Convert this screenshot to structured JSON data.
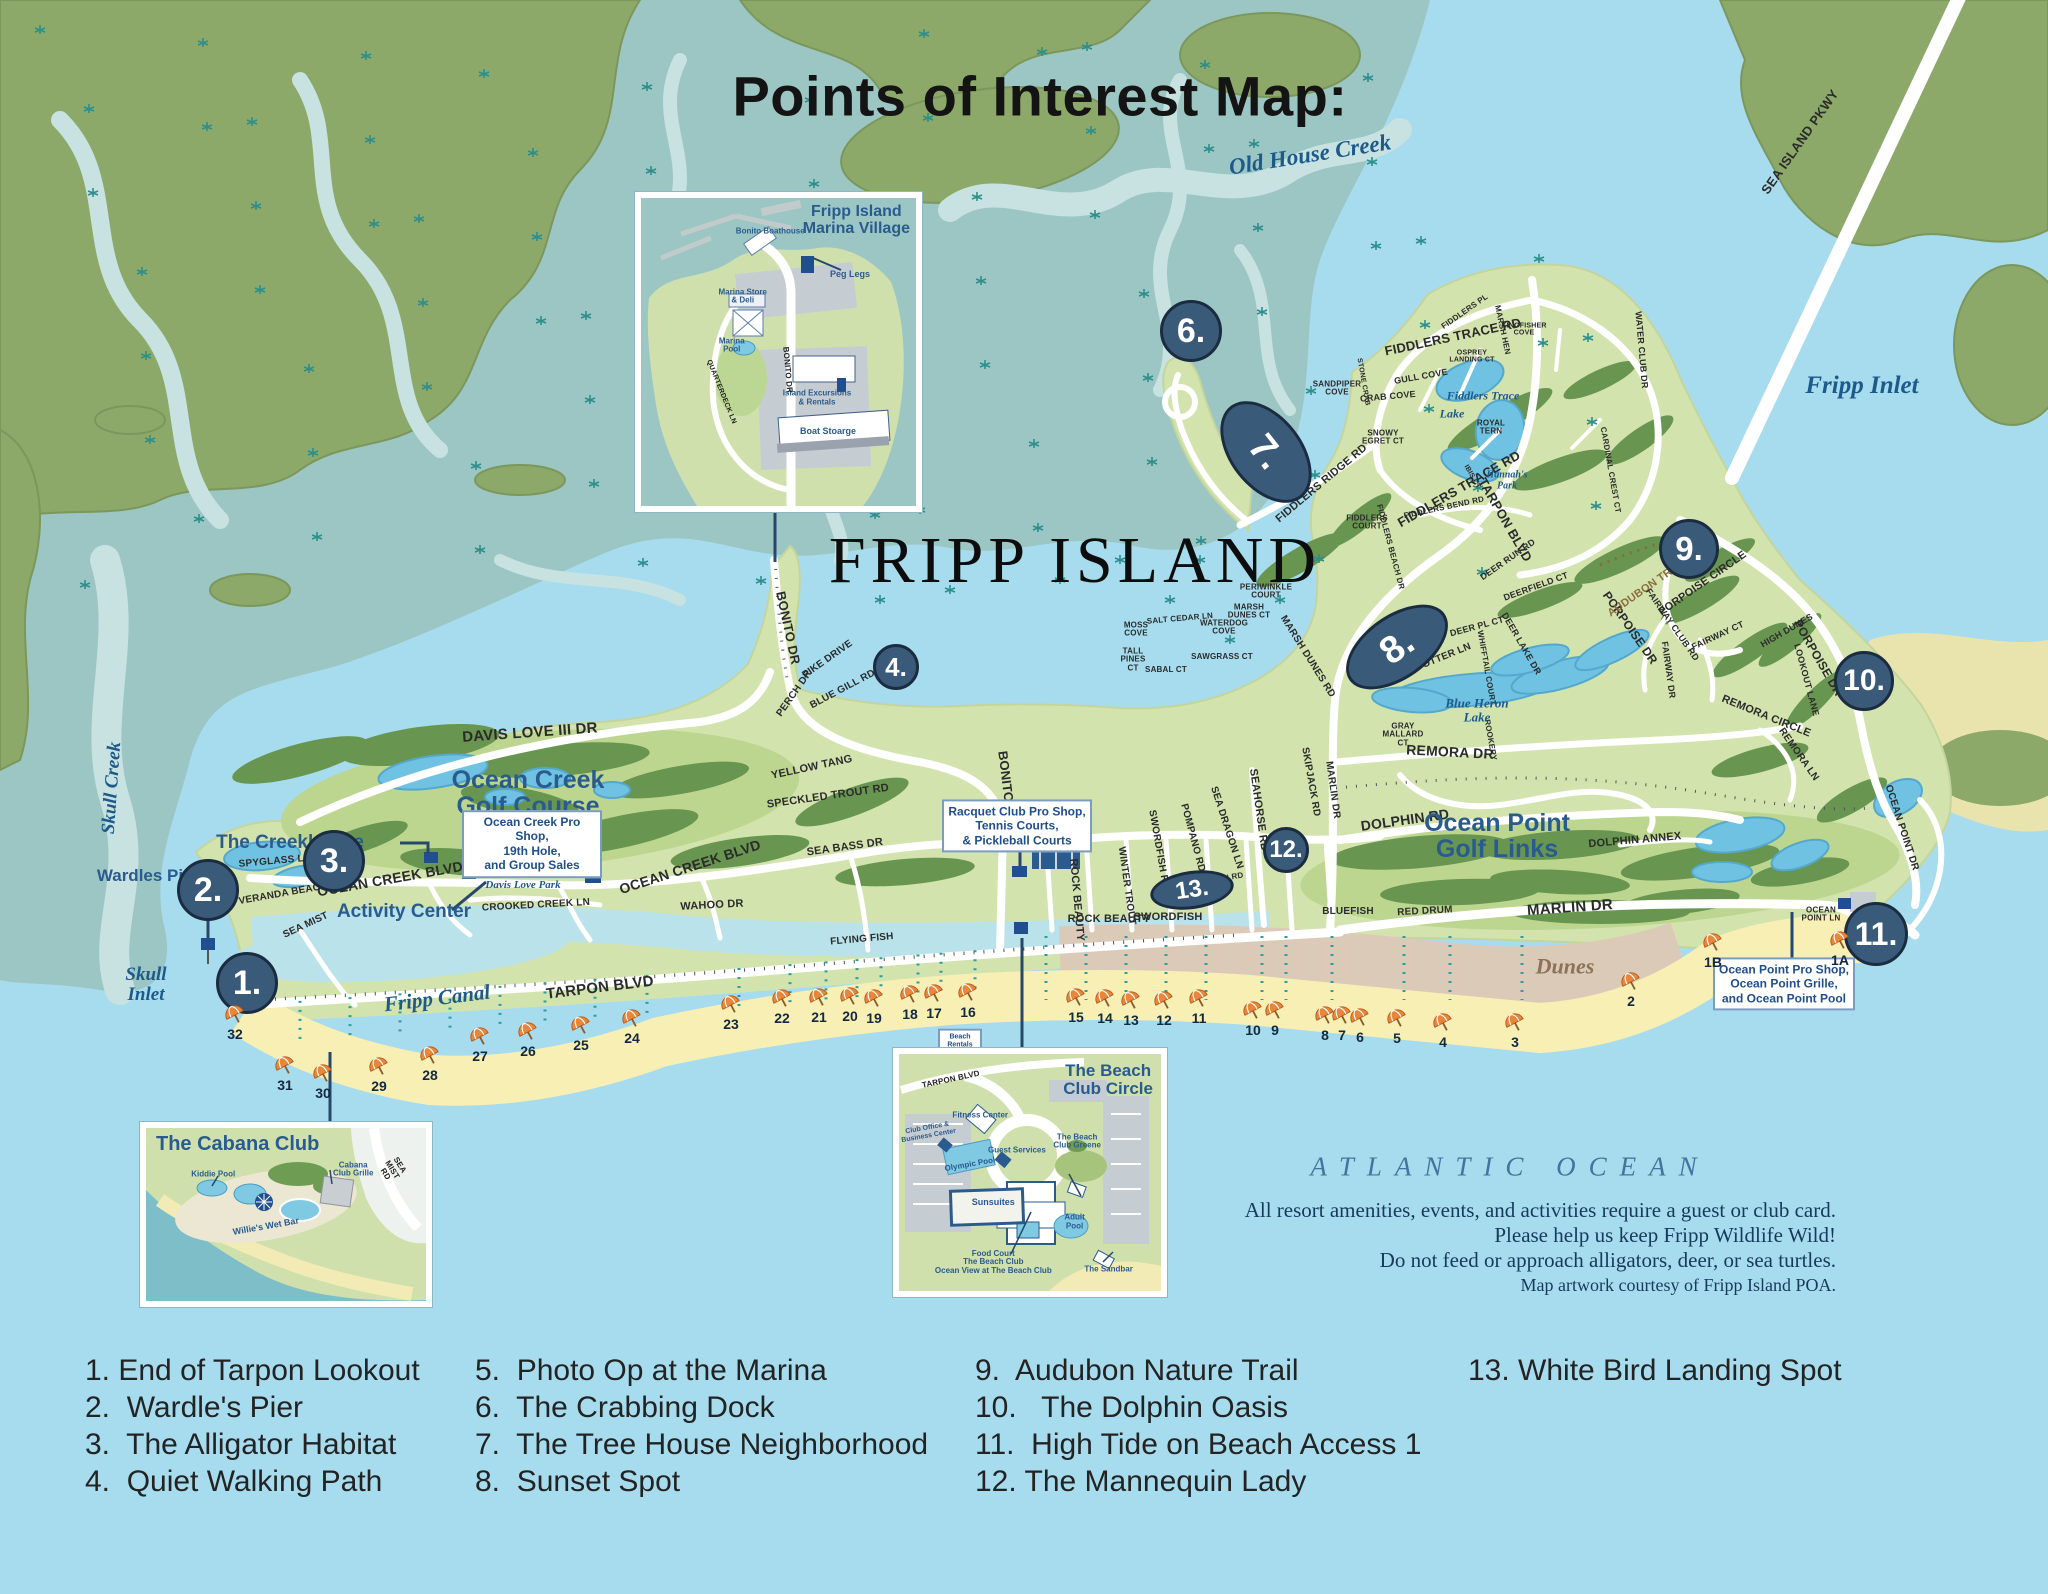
{
  "title": "Points of Interest Map:",
  "island_label": "FRIPP ISLAND",
  "ocean": {
    "name": "ATLANTIC OCEAN",
    "notes": [
      "All resort amenities, events, and activities require a guest or club card.",
      "Please help us keep Fripp Wildlife Wild!",
      "Do not feed or approach alligators, deer, or sea turtles.",
      "Map artwork courtesy of Fripp Island POA."
    ]
  },
  "legend": {
    "columns": [
      {
        "x": 85,
        "items": [
          "1. End of Tarpon Lookout",
          "2.  Wardle's Pier",
          "3.  The Alligator Habitat",
          "4.  Quiet Walking Path"
        ]
      },
      {
        "x": 475,
        "items": [
          "5.  Photo Op at the Marina",
          "6.  The Crabbing Dock",
          "7.  The Tree House Neighborhood",
          "8.  Sunset Spot"
        ]
      },
      {
        "x": 975,
        "items": [
          "9.  Audubon Nature Trail",
          "10.   The Dolphin Oasis",
          "11.  High Tide on Beach Access 1",
          "12. The Mannequin Lady"
        ]
      },
      {
        "x": 1468,
        "items": [
          "13. White Bird Landing Spot"
        ]
      }
    ]
  },
  "markers": [
    {
      "t": "1.",
      "x": 247,
      "y": 983,
      "w": 62,
      "h": 62,
      "fs": 34
    },
    {
      "t": "2.",
      "x": 208,
      "y": 890,
      "w": 62,
      "h": 62,
      "fs": 34
    },
    {
      "t": "3.",
      "x": 334,
      "y": 861,
      "w": 62,
      "h": 62,
      "fs": 34
    },
    {
      "t": "4.",
      "x": 896,
      "y": 667,
      "w": 46,
      "h": 46,
      "fs": 26
    },
    {
      "t": "5.",
      "x": 682,
      "y": 237,
      "w": 60,
      "h": 60,
      "fs": 32
    },
    {
      "t": "6.",
      "x": 1191,
      "y": 331,
      "w": 62,
      "h": 62,
      "fs": 34
    },
    {
      "t": "7.",
      "x": 1266,
      "y": 452,
      "w": 116,
      "h": 72,
      "r": 52,
      "fs": 38
    },
    {
      "t": "8.",
      "x": 1397,
      "y": 647,
      "w": 116,
      "h": 64,
      "r": -35,
      "fs": 38
    },
    {
      "t": "9.",
      "x": 1689,
      "y": 549,
      "w": 60,
      "h": 60,
      "fs": 33
    },
    {
      "t": "10.",
      "x": 1864,
      "y": 681,
      "w": 60,
      "h": 60,
      "fs": 30
    },
    {
      "t": "11.",
      "x": 1876,
      "y": 934,
      "w": 64,
      "h": 64,
      "fs": 32
    },
    {
      "t": "12.",
      "x": 1286,
      "y": 850,
      "w": 46,
      "h": 46,
      "fs": 24
    },
    {
      "t": "13.",
      "x": 1192,
      "y": 890,
      "w": 84,
      "h": 38,
      "r": -8,
      "fs": 24
    }
  ],
  "place_labels": [
    {
      "t": "The Creekhouse",
      "x": 290,
      "y": 843,
      "s": 19
    },
    {
      "t": "Wardles Pier",
      "x": 148,
      "y": 876,
      "s": 17
    },
    {
      "t": "Activity Center",
      "x": 404,
      "y": 912,
      "s": 19
    },
    {
      "t": "Ocean Creek\nGolf Course",
      "x": 528,
      "y": 793,
      "s": 25
    },
    {
      "t": "Ocean Point\nGolf Links",
      "x": 1497,
      "y": 836,
      "s": 25
    }
  ],
  "water_labels": [
    {
      "t": "Old House Creek",
      "x": 1310,
      "y": 155,
      "r": -9,
      "s": 23
    },
    {
      "t": "Fripp Inlet",
      "x": 1862,
      "y": 386,
      "s": 25
    },
    {
      "t": "Skull Creek",
      "x": 112,
      "y": 788,
      "r": -86,
      "s": 19
    },
    {
      "t": "Skull\nInlet",
      "x": 146,
      "y": 985,
      "s": 19
    },
    {
      "t": "Fripp Canal",
      "x": 437,
      "y": 998,
      "r": -7,
      "s": 21
    },
    {
      "t": "Fiddlers Trace",
      "x": 1483,
      "y": 396,
      "s": 12
    },
    {
      "t": "Lake",
      "x": 1452,
      "y": 414,
      "s": 12
    },
    {
      "t": "Blue Heron\nLake",
      "x": 1477,
      "y": 710,
      "s": 13
    },
    {
      "t": "Hannah's\nPark",
      "x": 1507,
      "y": 481,
      "s": 10
    },
    {
      "t": "Davis Love Park",
      "x": 523,
      "y": 886,
      "s": 11
    },
    {
      "t": "Dunes",
      "x": 1565,
      "y": 966,
      "s": 22,
      "c": "tan"
    }
  ],
  "road_labels": [
    {
      "t": "DAVIS LOVE III DR",
      "x": 530,
      "y": 733,
      "r": -4,
      "s": 15
    },
    {
      "t": "OCEAN CREEK BLVD",
      "x": 390,
      "y": 879,
      "r": -10,
      "s": 14
    },
    {
      "t": "OCEAN CREEK BLVD",
      "x": 690,
      "y": 867,
      "r": -18,
      "s": 14
    },
    {
      "t": "SPYGLASS LN",
      "x": 275,
      "y": 862,
      "r": -5,
      "s": 10
    },
    {
      "t": "VERANDA BEACH DR",
      "x": 292,
      "y": 893,
      "r": -10,
      "s": 10
    },
    {
      "t": "SEA MIST",
      "x": 306,
      "y": 926,
      "r": -25,
      "s": 10
    },
    {
      "t": "TARPON BLVD",
      "x": 600,
      "y": 988,
      "r": -7,
      "s": 15
    },
    {
      "t": "CROOKED CREEK LN",
      "x": 536,
      "y": 906,
      "r": -3,
      "s": 10
    },
    {
      "t": "WAHOO DR",
      "x": 712,
      "y": 906,
      "r": -3,
      "s": 11
    },
    {
      "t": "SEA BASS DR",
      "x": 845,
      "y": 848,
      "r": -8,
      "s": 11
    },
    {
      "t": "YELLOW TANG",
      "x": 812,
      "y": 768,
      "r": -12,
      "s": 11
    },
    {
      "t": "SPECKLED TROUT RD",
      "x": 828,
      "y": 797,
      "r": -8,
      "s": 11
    },
    {
      "t": "BONITO DR",
      "x": 1007,
      "y": 788,
      "r": 83,
      "s": 13
    },
    {
      "t": "BONITO DR",
      "x": 788,
      "y": 628,
      "r": 78,
      "s": 13
    },
    {
      "t": "PIKE DRIVE",
      "x": 828,
      "y": 660,
      "r": -35,
      "s": 10
    },
    {
      "t": "BLUE GILL RD",
      "x": 843,
      "y": 690,
      "r": -28,
      "s": 10
    },
    {
      "t": "PERCH DR",
      "x": 795,
      "y": 694,
      "r": -55,
      "s": 10
    },
    {
      "t": "FLYING FISH",
      "x": 862,
      "y": 940,
      "r": -5,
      "s": 10
    },
    {
      "t": "ROCK BEAUTY",
      "x": 1076,
      "y": 900,
      "r": 85,
      "s": 11
    },
    {
      "t": "ROCK BEAUTY",
      "x": 1109,
      "y": 920,
      "r": 0,
      "s": 11
    },
    {
      "t": "SWORDFISH",
      "x": 1168,
      "y": 918,
      "r": 0,
      "s": 11
    },
    {
      "t": "WINTER TROUT",
      "x": 1126,
      "y": 886,
      "r": 82,
      "s": 10
    },
    {
      "t": "SWORDFISH RD",
      "x": 1158,
      "y": 850,
      "r": 80,
      "s": 10
    },
    {
      "t": "POMPANO RD",
      "x": 1192,
      "y": 838,
      "r": 75,
      "s": 10
    },
    {
      "t": "SEA DRAGON LN",
      "x": 1226,
      "y": 828,
      "r": 72,
      "s": 10
    },
    {
      "t": "SEAHORSE RD",
      "x": 1258,
      "y": 810,
      "r": 82,
      "s": 11
    },
    {
      "t": "SKIPJACK RD",
      "x": 1310,
      "y": 782,
      "r": 80,
      "s": 10
    },
    {
      "t": "MARLIN DR",
      "x": 1332,
      "y": 790,
      "r": 82,
      "s": 10
    },
    {
      "t": "BLUEFISH",
      "x": 1348,
      "y": 912,
      "r": 0,
      "s": 10
    },
    {
      "t": "RED DRUM",
      "x": 1425,
      "y": 912,
      "r": -3,
      "s": 10
    },
    {
      "t": "MARLIN DR",
      "x": 1570,
      "y": 908,
      "r": -4,
      "s": 15
    },
    {
      "t": "DOLPHIN RD",
      "x": 1405,
      "y": 820,
      "r": -8,
      "s": 14
    },
    {
      "t": "DOLPHIN RD",
      "x": 1218,
      "y": 880,
      "r": -10,
      "s": 8
    },
    {
      "t": "DOLPHIN ANNEX",
      "x": 1635,
      "y": 841,
      "r": -5,
      "s": 11
    },
    {
      "t": "REMORA DR",
      "x": 1450,
      "y": 752,
      "r": 3,
      "s": 14
    },
    {
      "t": "REMORA CIRCLE",
      "x": 1766,
      "y": 717,
      "r": 22,
      "s": 11
    },
    {
      "t": "REMORA LN",
      "x": 1798,
      "y": 755,
      "r": 55,
      "s": 10
    },
    {
      "t": "PORPOISE DR",
      "x": 1630,
      "y": 628,
      "r": 55,
      "s": 12
    },
    {
      "t": "PORPOISE DR",
      "x": 1818,
      "y": 658,
      "r": 60,
      "s": 12
    },
    {
      "t": "PORPOISE CIRCLE",
      "x": 1703,
      "y": 584,
      "r": -35,
      "s": 11
    },
    {
      "t": "AUDUBON TRAIL",
      "x": 1648,
      "y": 588,
      "r": -35,
      "s": 11,
      "c": "brown"
    },
    {
      "t": "FAIRWAY CLUB RD",
      "x": 1672,
      "y": 625,
      "r": 55,
      "s": 9
    },
    {
      "t": "FAIRWAY CT",
      "x": 1718,
      "y": 636,
      "r": -25,
      "s": 9
    },
    {
      "t": "FAIRWAY DR",
      "x": 1668,
      "y": 670,
      "r": 82,
      "s": 9
    },
    {
      "t": "HIGH DUNES",
      "x": 1787,
      "y": 631,
      "r": -30,
      "s": 9
    },
    {
      "t": "LOOKOUT LANE",
      "x": 1806,
      "y": 680,
      "r": 75,
      "s": 9
    },
    {
      "t": "MARSH DUNES RD",
      "x": 1307,
      "y": 657,
      "r": 58,
      "s": 10
    },
    {
      "t": "SEA OTTER LN",
      "x": 1436,
      "y": 661,
      "r": -22,
      "s": 10
    },
    {
      "t": "GRAY\nMALLARD\nCT",
      "x": 1403,
      "y": 735,
      "r": 0,
      "s": 8
    },
    {
      "t": "DEER PL CT",
      "x": 1477,
      "y": 627,
      "r": -15,
      "s": 9
    },
    {
      "t": "DEER LAKE DR",
      "x": 1521,
      "y": 644,
      "r": 60,
      "s": 9
    },
    {
      "t": "DEERFIELD CT",
      "x": 1536,
      "y": 587,
      "r": -20,
      "s": 9
    },
    {
      "t": "DEER RUN RD",
      "x": 1508,
      "y": 560,
      "r": -35,
      "s": 9
    },
    {
      "t": "WHIFFTAIL COURT",
      "x": 1486,
      "y": 668,
      "r": 80,
      "s": 8
    },
    {
      "t": "ROOKERY",
      "x": 1490,
      "y": 740,
      "r": 80,
      "s": 8
    },
    {
      "t": "TARPON BLVD",
      "x": 1505,
      "y": 520,
      "r": 60,
      "s": 13
    },
    {
      "t": "FIDDLERS TRACE RD",
      "x": 1453,
      "y": 337,
      "r": -12,
      "s": 13
    },
    {
      "t": "FIDDLERS TRACE RD",
      "x": 1459,
      "y": 489,
      "r": -30,
      "s": 13
    },
    {
      "t": "FIDDLERS RIDGE RD",
      "x": 1322,
      "y": 484,
      "r": -40,
      "s": 11
    },
    {
      "t": "FIDDLERS BEND RD",
      "x": 1444,
      "y": 508,
      "r": -12,
      "s": 8
    },
    {
      "t": "FIDDLERS\nCOURT",
      "x": 1367,
      "y": 523,
      "r": 0,
      "s": 8
    },
    {
      "t": "FIDDLERS BEACH DR",
      "x": 1390,
      "y": 547,
      "r": 75,
      "s": 8
    },
    {
      "t": "SANDPIPER\nCOVE",
      "x": 1337,
      "y": 389,
      "r": 0,
      "s": 8
    },
    {
      "t": "CRAB COVE",
      "x": 1388,
      "y": 397,
      "r": -5,
      "s": 9
    },
    {
      "t": "GULL COVE",
      "x": 1421,
      "y": 377,
      "r": -10,
      "s": 9
    },
    {
      "t": "STONE CRAB",
      "x": 1363,
      "y": 382,
      "r": 80,
      "s": 7
    },
    {
      "t": "SNOWY\nEGRET CT",
      "x": 1383,
      "y": 438,
      "r": 0,
      "s": 8
    },
    {
      "t": "OSPREY\nLANDING CT",
      "x": 1472,
      "y": 357,
      "r": 0,
      "s": 7
    },
    {
      "t": "FIDDLERS PL",
      "x": 1465,
      "y": 312,
      "r": -35,
      "s": 8
    },
    {
      "t": "MARSH HEN",
      "x": 1502,
      "y": 330,
      "r": 78,
      "s": 8
    },
    {
      "t": "ROYAL\nTERN",
      "x": 1491,
      "y": 428,
      "r": 0,
      "s": 8
    },
    {
      "t": "KINGFISHER\nCOVE",
      "x": 1524,
      "y": 330,
      "r": 0,
      "s": 7
    },
    {
      "t": "IBIS CT",
      "x": 1472,
      "y": 477,
      "r": 60,
      "s": 7
    },
    {
      "t": "WATER CLUB DR",
      "x": 1641,
      "y": 350,
      "r": 85,
      "s": 9
    },
    {
      "t": "CARDINAL CREST CT",
      "x": 1610,
      "y": 470,
      "r": 80,
      "s": 8
    },
    {
      "t": "MOSS\nCOVE",
      "x": 1136,
      "y": 630,
      "r": 0,
      "s": 8
    },
    {
      "t": "SALT CEDAR LN",
      "x": 1180,
      "y": 619,
      "r": -5,
      "s": 8
    },
    {
      "t": "WATERDOG\nCOVE",
      "x": 1224,
      "y": 628,
      "r": 0,
      "s": 8
    },
    {
      "t": "MARSH\nDUNES CT",
      "x": 1249,
      "y": 612,
      "r": 0,
      "s": 8
    },
    {
      "t": "PERIWINKLE\nCOURT",
      "x": 1266,
      "y": 592,
      "r": 0,
      "s": 8
    },
    {
      "t": "TALL\nPINES\nCT",
      "x": 1133,
      "y": 660,
      "r": 0,
      "s": 8
    },
    {
      "t": "SABAL CT",
      "x": 1166,
      "y": 670,
      "r": 0,
      "s": 8
    },
    {
      "t": "SAWGRASS CT",
      "x": 1222,
      "y": 657,
      "r": 0,
      "s": 8
    },
    {
      "t": "OCEAN POINT DR",
      "x": 1901,
      "y": 828,
      "r": 72,
      "s": 10
    },
    {
      "t": "OCEAN\nPOINT LN",
      "x": 1821,
      "y": 915,
      "r": 0,
      "s": 8
    },
    {
      "t": "SEA ISLAND PKWY",
      "x": 1800,
      "y": 142,
      "r": -55,
      "s": 13
    }
  ],
  "info_boxes": [
    {
      "lines": [
        "Ocean Creek Pro Shop,",
        "19th Hole,",
        "and Group Sales"
      ],
      "x": 532,
      "y": 844,
      "w": 140,
      "s": 12
    },
    {
      "lines": [
        "Racquet Club Pro Shop,",
        "Tennis Courts,",
        "& Pickleball Courts"
      ],
      "x": 1017,
      "y": 826,
      "w": 150,
      "s": 12
    },
    {
      "lines": [
        "Ocean Point Pro Shop,",
        "Ocean Point Grille,",
        "and Ocean Point Pool"
      ],
      "x": 1784,
      "y": 984,
      "w": 142,
      "s": 12
    },
    {
      "lines": [
        "Beach",
        "Rentals"
      ],
      "x": 960,
      "y": 1042,
      "w": 44,
      "s": 7
    }
  ],
  "umbrellas": [
    {
      "label": "32",
      "x": 235,
      "y": 1024
    },
    {
      "label": "31",
      "x": 285,
      "y": 1075
    },
    {
      "label": "30",
      "x": 323,
      "y": 1083
    },
    {
      "label": "29",
      "x": 379,
      "y": 1076
    },
    {
      "label": "28",
      "x": 430,
      "y": 1065
    },
    {
      "label": "27",
      "x": 480,
      "y": 1046
    },
    {
      "label": "26",
      "x": 528,
      "y": 1041
    },
    {
      "label": "25",
      "x": 581,
      "y": 1035
    },
    {
      "label": "24",
      "x": 632,
      "y": 1028
    },
    {
      "label": "23",
      "x": 731,
      "y": 1014
    },
    {
      "label": "22",
      "x": 782,
      "y": 1008
    },
    {
      "label": "21",
      "x": 819,
      "y": 1007
    },
    {
      "label": "20",
      "x": 850,
      "y": 1006
    },
    {
      "label": "19",
      "x": 874,
      "y": 1008
    },
    {
      "label": "18",
      "x": 910,
      "y": 1004
    },
    {
      "label": "17",
      "x": 934,
      "y": 1003
    },
    {
      "label": "16",
      "x": 968,
      "y": 1002
    },
    {
      "label": "15",
      "x": 1076,
      "y": 1007
    },
    {
      "label": "14",
      "x": 1105,
      "y": 1008
    },
    {
      "label": "13",
      "x": 1131,
      "y": 1010
    },
    {
      "label": "12",
      "x": 1164,
      "y": 1010
    },
    {
      "label": "11",
      "x": 1199,
      "y": 1008
    },
    {
      "label": "10",
      "x": 1253,
      "y": 1020
    },
    {
      "label": "9",
      "x": 1275,
      "y": 1020
    },
    {
      "label": "8",
      "x": 1325,
      "y": 1025
    },
    {
      "label": "7",
      "x": 1342,
      "y": 1025
    },
    {
      "label": "6",
      "x": 1360,
      "y": 1027
    },
    {
      "label": "5",
      "x": 1397,
      "y": 1028
    },
    {
      "label": "4",
      "x": 1443,
      "y": 1032
    },
    {
      "label": "3",
      "x": 1515,
      "y": 1032
    },
    {
      "label": "2",
      "x": 1631,
      "y": 991
    },
    {
      "label": "1B",
      "x": 1713,
      "y": 952
    },
    {
      "label": "1A",
      "x": 1840,
      "y": 950
    }
  ],
  "insets": {
    "marina": {
      "title": "Fripp Island\nM arina Village",
      "labels": [
        {
          "t": "Bonito Boathouse",
          "x": 47,
          "y": 11,
          "s": 8,
          "c": "blue"
        },
        {
          "t": "Peg Legs",
          "x": 76,
          "y": 25,
          "s": 9,
          "c": "blue"
        },
        {
          "t": "Marina Store\n& Deli",
          "x": 37,
          "y": 32,
          "s": 8,
          "c": "blue"
        },
        {
          "t": "Marina\nPool",
          "x": 33,
          "y": 48,
          "s": 8,
          "c": "blue"
        },
        {
          "t": "Island Excursions\n& Rentals",
          "x": 64,
          "y": 65,
          "s": 8,
          "c": "blue"
        },
        {
          "t": "Boat Stoarge",
          "x": 68,
          "y": 76,
          "s": 9,
          "c": "blue"
        },
        {
          "t": "BONITO DR",
          "x": 53,
          "y": 56,
          "s": 8,
          "r": 85,
          "c": "road"
        },
        {
          "t": "QUARTERDECK LN",
          "x": 29,
          "y": 63,
          "s": 7,
          "r": 68,
          "c": "road"
        }
      ]
    },
    "cabana": {
      "title": "The Cabana Club",
      "labels": [
        {
          "t": "Kiddie Pool",
          "x": 24,
          "y": 27,
          "s": 8,
          "c": "blue"
        },
        {
          "t": "Cabana\nClub Grille",
          "x": 74,
          "y": 24,
          "s": 8,
          "c": "blue"
        },
        {
          "t": "Willie's Wet Bar",
          "x": 43,
          "y": 57,
          "s": 9,
          "r": -10,
          "c": "blue"
        },
        {
          "t": "SEA MIST RD",
          "x": 88,
          "y": 24,
          "s": 8,
          "r": 58,
          "c": "road"
        }
      ]
    },
    "beach_club": {
      "title": "The Beach\nClub Circle",
      "labels": [
        {
          "t": "TARPON BLVD",
          "x": 20,
          "y": 11,
          "s": 8,
          "r": -12,
          "c": "road"
        },
        {
          "t": "Fitness Center",
          "x": 31,
          "y": 26,
          "s": 8,
          "c": "blue"
        },
        {
          "t": "Club Office &\nBusiness Center",
          "x": 11,
          "y": 33,
          "s": 7,
          "r": -10,
          "c": "blue"
        },
        {
          "t": "Guest Services",
          "x": 45,
          "y": 41,
          "s": 8,
          "c": "blue"
        },
        {
          "t": "Olympic Pool",
          "x": 27,
          "y": 47,
          "s": 8,
          "r": -10,
          "c": "blue"
        },
        {
          "t": "Sunsuites",
          "x": 36,
          "y": 63,
          "s": 9,
          "c": "blue"
        },
        {
          "t": "The Beach\nClub Greene",
          "x": 68,
          "y": 37,
          "s": 8,
          "c": "blue"
        },
        {
          "t": "Adult\nPool",
          "x": 67,
          "y": 71,
          "s": 8,
          "c": "blue"
        },
        {
          "t": "Food Court\nThe Beach Club\nOcean View at The Beach Club",
          "x": 36,
          "y": 88,
          "s": 8,
          "c": "blue"
        },
        {
          "t": "The Sandbar",
          "x": 80,
          "y": 91,
          "s": 8,
          "c": "blue"
        }
      ]
    }
  },
  "colors": {
    "ocean": "#a6dcee",
    "marsh_water": "#9cc6c3",
    "marsh_land": "#8ca969",
    "island": "#d3e3ae",
    "golf_green": "#68954f",
    "lake": "#6fc2e1",
    "sand": "#f8efb5",
    "dunes": "#dccab8",
    "road": "#ffffff",
    "marker": "#3a5a7a",
    "label_blue": "#2a5b8e",
    "water_label": "#1d5a8a"
  }
}
